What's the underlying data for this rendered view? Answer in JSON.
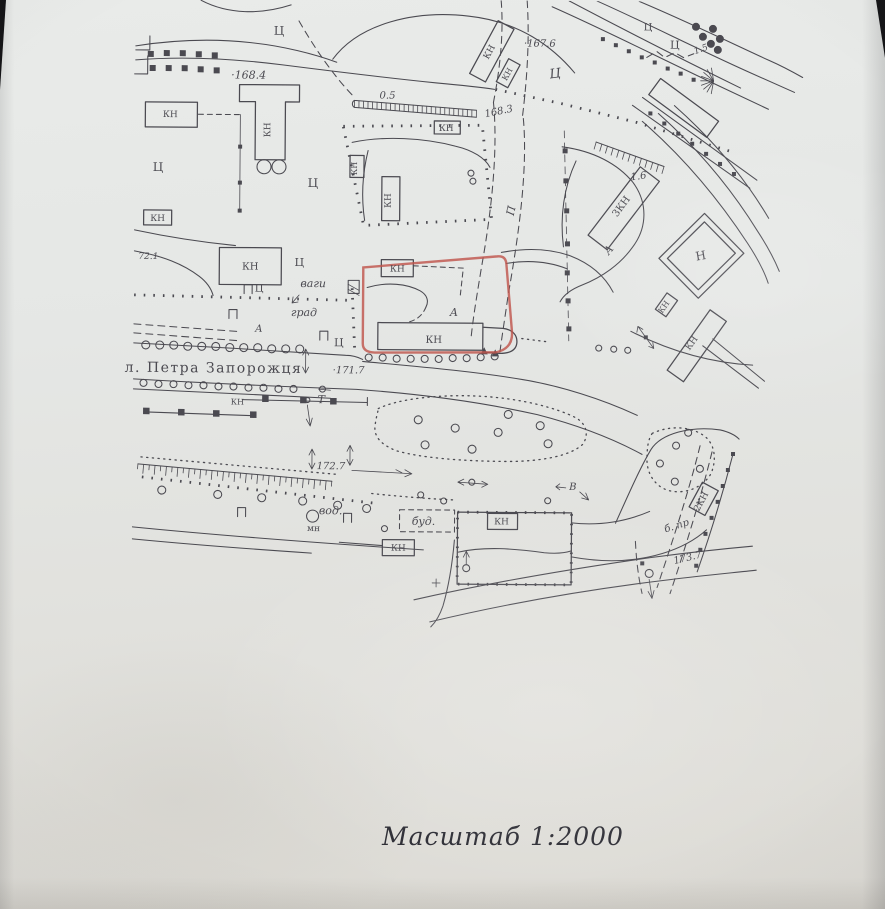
{
  "caption": {
    "text": "Масштаб  1:2000"
  },
  "colors": {
    "ink": "#4b4a51",
    "parcel_red": "#c0564d",
    "paper": "#e4e6e4",
    "caption_ink": "#26262e"
  },
  "map": {
    "street_name": "л. Петра Запорожця",
    "scale_value": "1:2000",
    "parcel_outline_color": "#c0564d",
    "elevations": [
      "168.4",
      "167.6",
      "168.3",
      "171.7",
      "172.7",
      "173.7",
      "72.1"
    ],
    "slope_values": [
      "0.5",
      "1.5",
      "1.6"
    ],
    "labels": [
      {
        "t": "Ц",
        "x": 276,
        "y": 36,
        "s": 12
      },
      {
        "t": "Ц",
        "x": 645,
        "y": 29,
        "s": 10
      },
      {
        "t": "Ц",
        "x": 672,
        "y": 47,
        "s": 11
      },
      {
        "t": "Ц",
        "x": 553,
        "y": 77,
        "s": 13,
        "r": -8,
        "i": true
      },
      {
        "t": "·167.6",
        "x": 537,
        "y": 46,
        "s": 10,
        "i": true
      },
      {
        "t": "·168.4",
        "x": 246,
        "y": 80,
        "s": 11,
        "i": true
      },
      {
        "t": "0.5",
        "x": 385,
        "y": 99,
        "s": 10,
        "i": true
      },
      {
        "t": "КН",
        "x": 444,
        "y": 131,
        "s": 9
      },
      {
        "t": "168.3",
        "x": 497,
        "y": 114,
        "s": 10,
        "i": true,
        "r": -12
      },
      {
        "t": "КН",
        "x": 489,
        "y": 53,
        "s": 9,
        "r": -62
      },
      {
        "t": "КН",
        "x": 507,
        "y": 75,
        "s": 8,
        "r": -62
      },
      {
        "t": "1.5",
        "x": 699,
        "y": 50,
        "s": 9,
        "i": true,
        "r": -20
      },
      {
        "t": "1.6",
        "x": 637,
        "y": 178,
        "s": 10,
        "i": true,
        "r": -8
      },
      {
        "t": "3КН",
        "x": 622,
        "y": 207,
        "s": 10,
        "r": -54
      },
      {
        "t": "А",
        "x": 610,
        "y": 251,
        "s": 11,
        "i": true,
        "r": -50
      },
      {
        "t": "Н",
        "x": 700,
        "y": 258,
        "s": 12,
        "r": -10
      },
      {
        "t": "КН",
        "x": 665,
        "y": 307,
        "s": 8,
        "r": -55
      },
      {
        "t": "КН",
        "x": 693,
        "y": 343,
        "s": 9,
        "r": -55
      },
      {
        "t": "Ц",
        "x": 156,
        "y": 173,
        "s": 12
      },
      {
        "t": "КН",
        "x": 168,
        "y": 119,
        "s": 9
      },
      {
        "t": "КН",
        "x": 268,
        "y": 131,
        "s": 9,
        "r": -90
      },
      {
        "t": "Ц",
        "x": 311,
        "y": 188,
        "s": 12
      },
      {
        "t": "П",
        "x": 513,
        "y": 211,
        "s": 11,
        "i": true,
        "r": -78
      },
      {
        "t": "КН",
        "x": 355,
        "y": 169,
        "s": 8,
        "r": -90
      },
      {
        "t": "КН",
        "x": 389,
        "y": 201,
        "s": 9,
        "r": -90
      },
      {
        "t": "КН",
        "x": 156,
        "y": 223,
        "s": 9
      },
      {
        "t": "72.1",
        "x": 147,
        "y": 261,
        "s": 9,
        "i": true
      },
      {
        "t": "КН",
        "x": 249,
        "y": 271,
        "s": 10
      },
      {
        "t": "Ц",
        "x": 298,
        "y": 267,
        "s": 11
      },
      {
        "t": "ваги",
        "x": 312,
        "y": 288,
        "s": 11,
        "i": true
      },
      {
        "t": "Ц",
        "x": 258,
        "y": 293,
        "s": 10
      },
      {
        "t": "град",
        "x": 303,
        "y": 317,
        "s": 11,
        "i": true
      },
      {
        "t": "А",
        "x": 258,
        "y": 333,
        "s": 10,
        "i": true
      },
      {
        "t": "Ц",
        "x": 338,
        "y": 347,
        "s": 11
      },
      {
        "t": "КН",
        "x": 396,
        "y": 272,
        "s": 9
      },
      {
        "t": "А",
        "x": 453,
        "y": 316,
        "s": 11,
        "i": true
      },
      {
        "t": "КН",
        "x": 433,
        "y": 343,
        "s": 10
      },
      {
        "t": "·171.7",
        "x": 348,
        "y": 374,
        "s": 10,
        "i": true
      },
      {
        "t": "л. Петра Запорожця",
        "x": 124,
        "y": 374,
        "s": 14,
        "a": "start",
        "ls": 1.5
      },
      {
        "t": "КН",
        "x": 237,
        "y": 406,
        "s": 8
      },
      {
        "t": "Т",
        "x": 321,
        "y": 404,
        "s": 11,
        "i": true
      },
      {
        "t": "172.7",
        "x": 331,
        "y": 470,
        "s": 10,
        "i": true
      },
      {
        "t": "вод.",
        "x": 331,
        "y": 515,
        "s": 11,
        "i": true
      },
      {
        "t": "мн",
        "x": 314,
        "y": 532,
        "s": 9
      },
      {
        "t": "буд.",
        "x": 424,
        "y": 525,
        "s": 11,
        "i": true
      },
      {
        "t": "КН",
        "x": 399,
        "y": 551,
        "s": 9
      },
      {
        "t": "КН",
        "x": 502,
        "y": 524,
        "s": 9
      },
      {
        "t": "В",
        "x": 573,
        "y": 489,
        "s": 10,
        "i": true
      },
      {
        "t": "2КН",
        "x": 704,
        "y": 501,
        "s": 9,
        "r": -62
      },
      {
        "t": "б. пр",
        "x": 678,
        "y": 527,
        "s": 10,
        "i": true,
        "r": -18
      },
      {
        "t": "173.7",
        "x": 689,
        "y": 559,
        "s": 10,
        "i": true,
        "r": -14
      }
    ]
  }
}
